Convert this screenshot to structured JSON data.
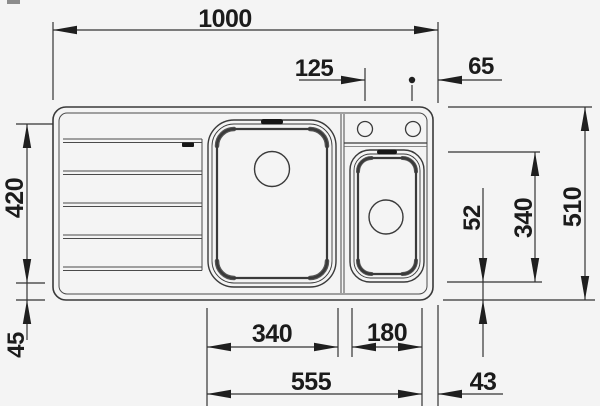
{
  "drawing": {
    "description": "Top-view dimensioned technical drawing of a kitchen sink with left drainboard, large main bowl, small half bowl and two faucet holes",
    "unit": "mm",
    "dimensions": {
      "overall_width": "1000",
      "faucet_hole_spacing": "125",
      "faucet_hole_to_right_edge": "65",
      "main_bowl_depth": "420",
      "main_bowl_to_front_edge": "45",
      "small_bowl_to_front_edge": "52",
      "small_bowl_depth": "340",
      "overall_depth": "510",
      "main_bowl_width": "340",
      "small_bowl_width": "180",
      "bowls_combined_width": "555",
      "small_bowl_to_right_edge": "43"
    }
  },
  "colors": {
    "background": "#f4f4f4",
    "line": "#3a3a3a",
    "dimension_text": "#1b1b1b"
  }
}
